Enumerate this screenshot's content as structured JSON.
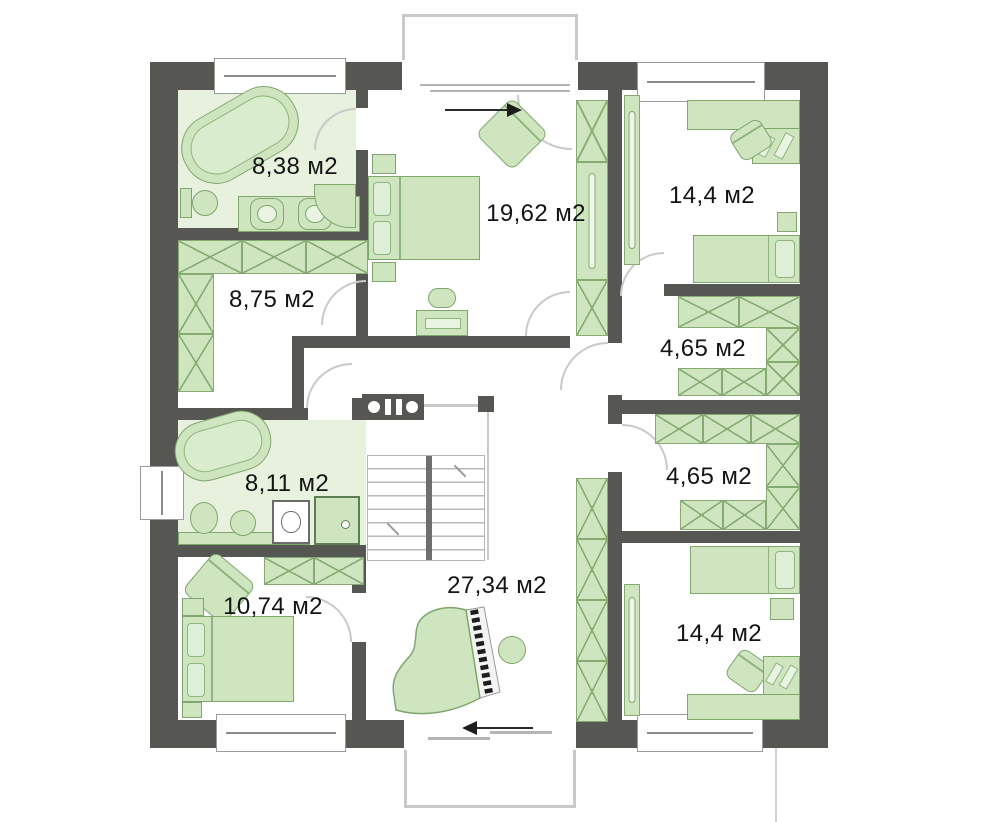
{
  "rooms": [
    {
      "id": "bathroom-top-left",
      "area": "8,38 м2"
    },
    {
      "id": "wardrobe-left",
      "area": "8,75 м2"
    },
    {
      "id": "bedroom-top-center",
      "area": "19,62 м2"
    },
    {
      "id": "bedroom-top-right",
      "area": "14,4 м2"
    },
    {
      "id": "closet-right-upper",
      "area": "4,65 м2"
    },
    {
      "id": "closet-right-lower",
      "area": "4,65 м2"
    },
    {
      "id": "bathroom-mid-left",
      "area": "8,11 м2"
    },
    {
      "id": "hall-center",
      "area": "27,34 м2"
    },
    {
      "id": "bedroom-bottom-left",
      "area": "10,74 м2"
    },
    {
      "id": "bedroom-bottom-right",
      "area": "14,4 м2"
    }
  ],
  "icons": {
    "balcony_exit_arrow_top": "right",
    "balcony_exit_arrow_bottom": "left"
  },
  "colors": {
    "wall": "#565652",
    "furniture_fill": "#cfe5c0",
    "furniture_outline": "#7fa76d",
    "bathroom_floor": "#e7f1de",
    "hatch": "#85ab72",
    "balcony_outline": "#c9c9c9",
    "label_text": "#141414"
  }
}
